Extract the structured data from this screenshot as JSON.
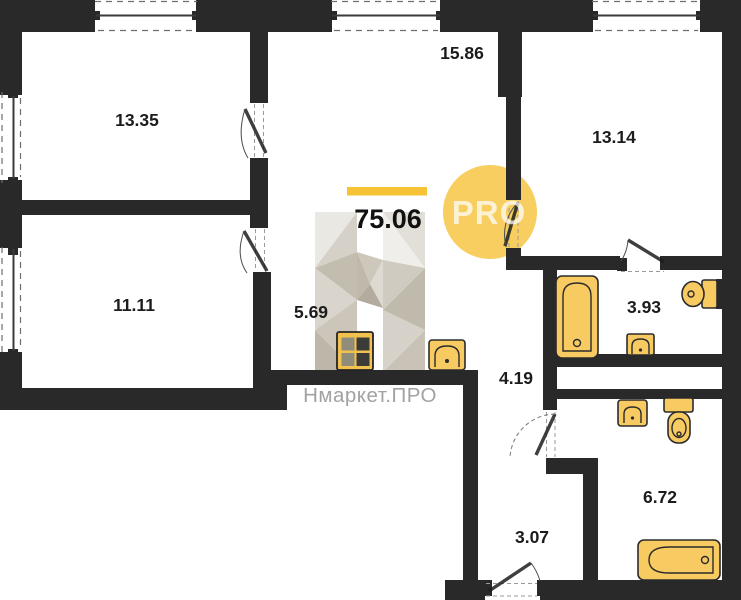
{
  "plan": {
    "total_area": "75.06",
    "badge_label": "PRO",
    "watermark_text": "Нмаркет.ПРО",
    "rooms": [
      {
        "name": "bedroom-top-left",
        "area": "13.35"
      },
      {
        "name": "living-room",
        "area": "15.86"
      },
      {
        "name": "bedroom-top-right",
        "area": "13.14"
      },
      {
        "name": "bedroom-bottom-left",
        "area": "11.11"
      },
      {
        "name": "kitchen-hall",
        "area": "5.69"
      },
      {
        "name": "bathroom-small",
        "area": "3.93"
      },
      {
        "name": "corridor",
        "area": "4.19"
      },
      {
        "name": "entry-hall",
        "area": "3.07"
      },
      {
        "name": "bathroom-large",
        "area": "6.72"
      }
    ],
    "colors": {
      "wall": "#29292a",
      "fixture_fill": "#f8ca62",
      "accent_bar": "#f5c335",
      "badge_fill": "#f7ce5f",
      "label_text": "#1c1c1c",
      "watermark_gray": "#a2a2a2"
    }
  }
}
